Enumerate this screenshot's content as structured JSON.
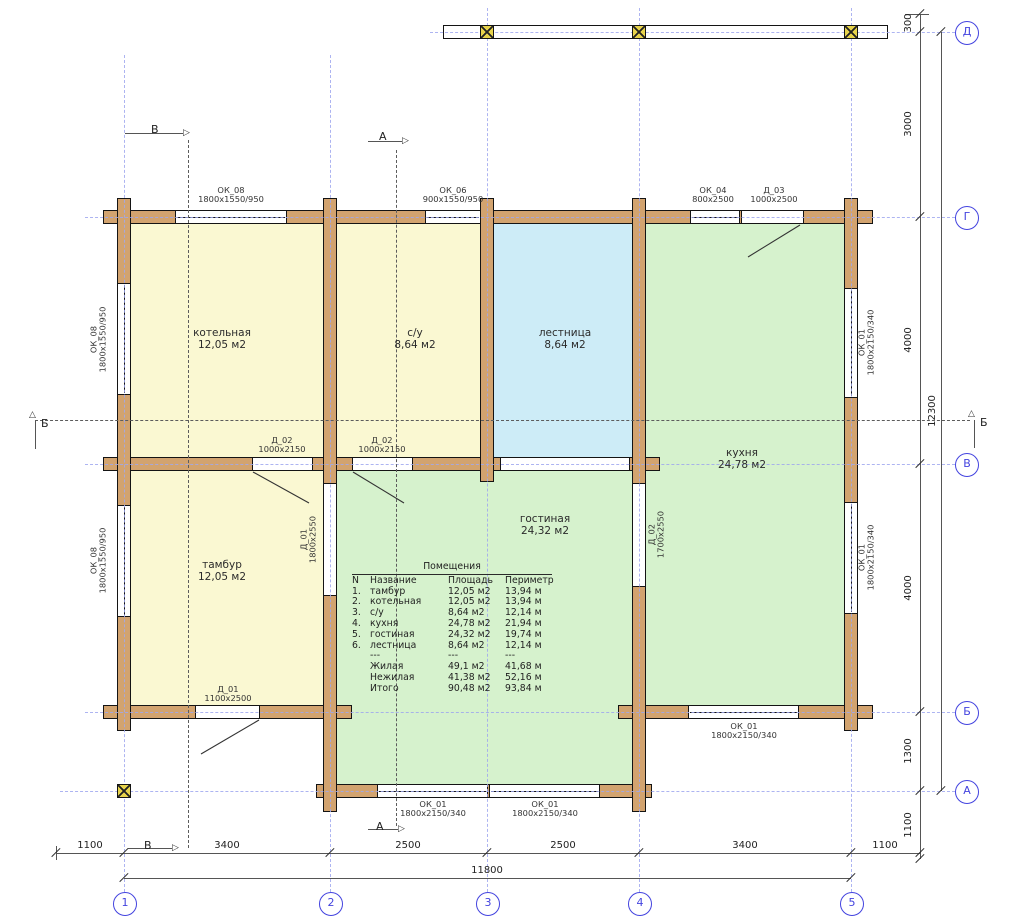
{
  "colors": {
    "wall": "#d2a36f",
    "room_yellow": "#faf8d2",
    "room_green": "#d6f2cd",
    "room_cyan": "#cdecf7",
    "grid_blue": "#9fa8ef",
    "axis_blue": "#4343df",
    "column_yellow": "#e7d34b"
  },
  "rooms": [
    {
      "name": "котельная",
      "area": "12,05 м2"
    },
    {
      "name": "с/у",
      "area": "8,64 м2"
    },
    {
      "name": "лестница",
      "area": "8,64 м2"
    },
    {
      "name": "кухня",
      "area": "24,78 м2"
    },
    {
      "name": "тамбур",
      "area": "12,05 м2"
    },
    {
      "name": "гостиная",
      "area": "24,32 м2"
    }
  ],
  "openings": {
    "okTop1": {
      "name": "ОК_08",
      "size": "1800х1550/950"
    },
    "okTop2": {
      "name": "ОК_06",
      "size": "900х1550/950"
    },
    "okTop3": {
      "name": "ОК_04",
      "size": "800х2500"
    },
    "dTop": {
      "name": "Д_03",
      "size": "1000х2500"
    },
    "d02a": {
      "name": "Д_02",
      "size": "1000х2150"
    },
    "d02b": {
      "name": "Д_02",
      "size": "1000х2150"
    },
    "d01b": {
      "name": "Д_01",
      "size": "1100х2500"
    },
    "okBr": {
      "name": "ОК_01",
      "size": "1800х2150/340"
    },
    "okA1": {
      "name": "ОК_01",
      "size": "1800х2150/340"
    },
    "okA2": {
      "name": "ОК_01",
      "size": "1800х2150/340"
    },
    "okL1": {
      "name": "ОК_08",
      "size": "1800х1550/950"
    },
    "okL2": {
      "name": "ОК_08",
      "size": "1800х1550/950"
    },
    "okR1": {
      "name": "ОК_01",
      "size": "1800х2150/340"
    },
    "okR2": {
      "name": "ОК_01",
      "size": "1800х2150/340"
    },
    "d01v": {
      "name": "Д_01",
      "size": "1800х2550"
    },
    "d02v": {
      "name": "Д_02",
      "size": "1700х2550"
    }
  },
  "table": {
    "title": "Помещения",
    "headers": [
      "N",
      "Название",
      "Площадь",
      "Периметр"
    ],
    "rows": [
      [
        "1.",
        "тамбур",
        "12,05 м2",
        "13,94 м"
      ],
      [
        "2.",
        "котельная",
        "12,05 м2",
        "13,94 м"
      ],
      [
        "3.",
        "с/у",
        "8,64 м2",
        "12,14 м"
      ],
      [
        "4.",
        "кухня",
        "24,78 м2",
        "21,94 м"
      ],
      [
        "5.",
        "гостиная",
        "24,32 м2",
        "19,74 м"
      ],
      [
        "6.",
        "лестница",
        "8,64 м2",
        "12,14 м"
      ]
    ],
    "sep": [
      "---",
      "---",
      "---"
    ],
    "totals": [
      [
        "Жилая",
        "49,1 м2",
        "41,68 м"
      ],
      [
        "Нежилая",
        "41,38 м2",
        "52,16 м"
      ],
      [
        "Итого",
        "90,48 м2",
        "93,84 м"
      ]
    ]
  },
  "axes": {
    "cols": [
      "1",
      "2",
      "3",
      "4",
      "5"
    ],
    "rows": [
      "Д",
      "Г",
      "В",
      "Б",
      "А"
    ]
  },
  "dims": {
    "bottom": [
      "1100",
      "3400",
      "2500",
      "2500",
      "3400",
      "1100"
    ],
    "bottom_total": "11800",
    "right": [
      "300",
      "3000",
      "4000",
      "4000",
      "1300",
      "1100"
    ],
    "right_total": "12300"
  },
  "sections": {
    "a": "А",
    "b": "Б",
    "v": "В"
  },
  "icons": {
    "tri_right": "▷",
    "tri_up": "△"
  }
}
